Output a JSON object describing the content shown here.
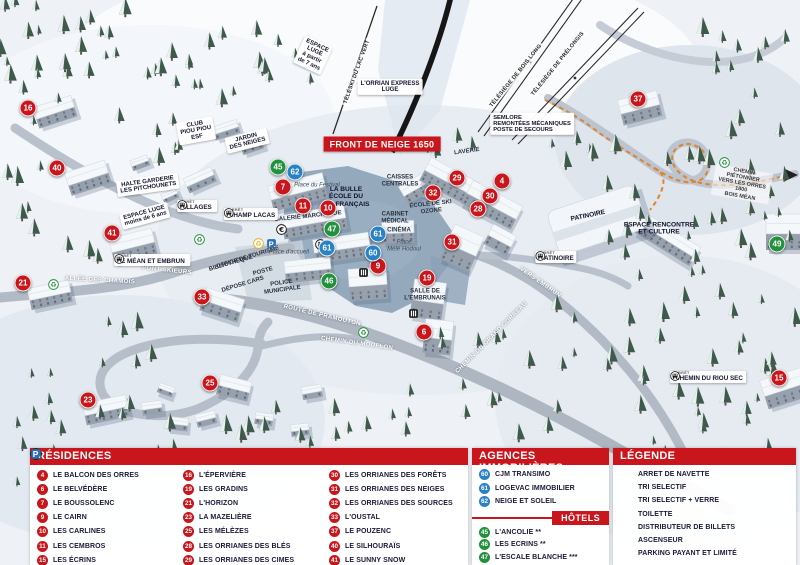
{
  "map": {
    "banner": "FRONT DE NEIGE 1650",
    "stop_prefix": "ARRÊT",
    "labels": [
      {
        "t": "L'ORRIAN EXPRESS\nLUGE",
        "s": "box",
        "x": 390,
        "y": 87,
        "r": 0
      },
      {
        "t": "ESPACE\nLUGE\nà partir\nde 7 ans",
        "s": "box",
        "x": 313,
        "y": 55,
        "r": 25
      },
      {
        "t": "TÉLÉSKI DU LAC VERT",
        "s": "lift",
        "x": 357,
        "y": 72,
        "r": -70
      },
      {
        "t": "TÉLÉSIÈGE DE BOIS LONG",
        "s": "lift",
        "x": 516,
        "y": 76,
        "r": -51
      },
      {
        "t": "TÉLÉSIÈGE DE PRÉLONGIS",
        "s": "lift",
        "x": 558,
        "y": 64,
        "r": -51
      },
      {
        "t": "SEMLORE\nREMONTÉES MÉCANIQUES\nPOSTE DE SECOURS",
        "s": "box-left",
        "x": 532,
        "y": 124,
        "r": 0
      },
      {
        "t": "CLUB\nPIOU PIOU\nESF",
        "s": "box",
        "x": 196,
        "y": 131,
        "r": -10
      },
      {
        "t": "JARDIN\nDES NEIGES",
        "s": "box",
        "x": 247,
        "y": 141,
        "r": -14
      },
      {
        "t": "HALTE GARDERIE\nLES PITCHOUNETS",
        "s": "box",
        "x": 148,
        "y": 185,
        "r": -8
      },
      {
        "t": "ESPACE LUGE\nmoins de 6 ans",
        "s": "box",
        "x": 145,
        "y": 216,
        "r": -15
      },
      {
        "t": "ALLÉE DES CHAMOIS",
        "s": "road",
        "x": 100,
        "y": 281,
        "r": 3
      },
      {
        "t": "PONT SKIEURS",
        "s": "road",
        "x": 167,
        "y": 271,
        "r": 6
      },
      {
        "t": "BIBLIOTHÈQUE",
        "s": "plain",
        "x": 231,
        "y": 264,
        "r": -16
      },
      {
        "t": "OFFICE DE TOURISME",
        "s": "plain",
        "x": 248,
        "y": 258,
        "r": -17
      },
      {
        "t": "POSTE",
        "s": "plain",
        "x": 263,
        "y": 272,
        "r": -15
      },
      {
        "t": "DÉPOSE CARS",
        "s": "plain",
        "x": 243,
        "y": 285,
        "r": -17
      },
      {
        "t": "POLICE\nMUNICIPALE",
        "s": "plain",
        "x": 282,
        "y": 287,
        "r": -8
      },
      {
        "t": "Place d'accueil",
        "s": "italic",
        "x": 289,
        "y": 253,
        "r": 0
      },
      {
        "t": "Place du Festival",
        "s": "italic",
        "x": 317,
        "y": 186,
        "r": 0
      },
      {
        "t": "LA BULLE\nÉCOLE DU\nSKI FRANÇAIS",
        "s": "plain-strong",
        "x": 346,
        "y": 197,
        "r": 0
      },
      {
        "t": "GALERIE MARCHANDE",
        "s": "plain",
        "x": 308,
        "y": 217,
        "r": -6
      },
      {
        "t": "CAISSES\nCENTRALES",
        "s": "plain",
        "x": 400,
        "y": 181,
        "r": 0
      },
      {
        "t": "CABINET\nMÉDICAL",
        "s": "plain",
        "x": 395,
        "y": 218,
        "r": 0
      },
      {
        "t": "CINÉMA",
        "s": "plain",
        "x": 399,
        "y": 231,
        "r": 0
      },
      {
        "t": "Place\nMélé Hodoul",
        "s": "italic",
        "x": 404,
        "y": 246,
        "r": 0
      },
      {
        "t": "ÉCOLE DE SKI\nOZONE",
        "s": "plain",
        "x": 431,
        "y": 208,
        "r": -6
      },
      {
        "t": "LAVERIE",
        "s": "plain",
        "x": 467,
        "y": 152,
        "r": -8
      },
      {
        "t": "SALLE DE\nL'EMBRUNAIS",
        "s": "plain",
        "x": 425,
        "y": 295,
        "r": 0
      },
      {
        "t": "PATINOIRE",
        "s": "plain-strong",
        "x": 588,
        "y": 216,
        "r": -12
      },
      {
        "t": "ESPACE RENCONTRE\nET CULTURE",
        "s": "plain-strong",
        "x": 659,
        "y": 229,
        "r": 0
      },
      {
        "t": "ROUTE DE PRAMOUTON",
        "s": "road",
        "x": 322,
        "y": 316,
        "r": 13
      },
      {
        "t": "CHEMIN DU MOUFLON",
        "s": "road",
        "x": 357,
        "y": 344,
        "r": 8
      },
      {
        "t": "CHEMIN DU GRAND CORREAU",
        "s": "road",
        "x": 492,
        "y": 338,
        "r": -45
      },
      {
        "t": "VERS EMBRUN",
        "s": "road",
        "x": 540,
        "y": 283,
        "r": 35
      },
      {
        "t": "CHEMIN PIÉTONNIER\nVERS LES ORRES 1800\nBOIS MÉAN",
        "s": "path-lbl",
        "x": 742,
        "y": 184,
        "r": 10
      }
    ],
    "stops": [
      {
        "name": "VILLAGES",
        "x": 197,
        "y": 206,
        "side": "right"
      },
      {
        "name": "CHAMP LACAS",
        "x": 251,
        "y": 214,
        "side": "left"
      },
      {
        "name": "LE MÉAN ET EMBRUN",
        "x": 152,
        "y": 260,
        "side": "right"
      },
      {
        "name": "PATINOIRE",
        "x": 556,
        "y": 257,
        "side": "left"
      },
      {
        "name": "CHEMIN DU RIOU SEC",
        "x": 708,
        "y": 377,
        "side": "left"
      }
    ],
    "markers": [
      {
        "n": "16",
        "c": "red",
        "x": 28,
        "y": 108
      },
      {
        "n": "40",
        "c": "red",
        "x": 57,
        "y": 168
      },
      {
        "n": "41",
        "c": "red",
        "x": 112,
        "y": 233
      },
      {
        "n": "21",
        "c": "red",
        "x": 23,
        "y": 283
      },
      {
        "n": "33",
        "c": "red",
        "x": 202,
        "y": 297
      },
      {
        "n": "23",
        "c": "red",
        "x": 88,
        "y": 400
      },
      {
        "n": "25",
        "c": "red",
        "x": 210,
        "y": 383
      },
      {
        "n": "7",
        "c": "red",
        "x": 283,
        "y": 187
      },
      {
        "n": "11",
        "c": "red",
        "x": 303,
        "y": 206
      },
      {
        "n": "10",
        "c": "red",
        "x": 328,
        "y": 208
      },
      {
        "n": "9",
        "c": "red",
        "x": 378,
        "y": 266
      },
      {
        "n": "19",
        "c": "red",
        "x": 427,
        "y": 278
      },
      {
        "n": "6",
        "c": "red",
        "x": 424,
        "y": 332
      },
      {
        "n": "31",
        "c": "red",
        "x": 452,
        "y": 242
      },
      {
        "n": "32",
        "c": "red",
        "x": 433,
        "y": 193
      },
      {
        "n": "29",
        "c": "red",
        "x": 457,
        "y": 178
      },
      {
        "n": "4",
        "c": "red",
        "x": 502,
        "y": 181
      },
      {
        "n": "30",
        "c": "red",
        "x": 490,
        "y": 196
      },
      {
        "n": "28",
        "c": "red",
        "x": 478,
        "y": 209
      },
      {
        "n": "37",
        "c": "red",
        "x": 638,
        "y": 99
      },
      {
        "n": "15",
        "c": "red",
        "x": 779,
        "y": 378
      },
      {
        "n": "45",
        "c": "green",
        "x": 278,
        "y": 167
      },
      {
        "n": "47",
        "c": "green",
        "x": 332,
        "y": 229
      },
      {
        "n": "46",
        "c": "green",
        "x": 329,
        "y": 281
      },
      {
        "n": "49",
        "c": "green",
        "x": 777,
        "y": 244
      },
      {
        "n": "62",
        "c": "blue",
        "x": 295,
        "y": 172
      },
      {
        "n": "61",
        "c": "blue",
        "x": 378,
        "y": 234
      },
      {
        "n": "61",
        "c": "blue",
        "x": 327,
        "y": 248
      },
      {
        "n": "60",
        "c": "blue",
        "x": 373,
        "y": 253
      }
    ],
    "icons": [
      {
        "icon": "recycle-green",
        "x": 48,
        "y": 279
      },
      {
        "icon": "recycle-green",
        "x": 194,
        "y": 234
      },
      {
        "icon": "recycle-green",
        "x": 358,
        "y": 327
      },
      {
        "icon": "recycle-green",
        "x": 719,
        "y": 157
      },
      {
        "icon": "recycle-yellow",
        "x": 253,
        "y": 238
      },
      {
        "icon": "parking",
        "x": 266,
        "y": 238
      },
      {
        "icon": "euro",
        "x": 276,
        "y": 224
      },
      {
        "icon": "wc",
        "x": 315,
        "y": 239
      },
      {
        "icon": "elevator",
        "x": 358,
        "y": 267
      },
      {
        "icon": "elevator",
        "x": 408,
        "y": 308
      }
    ]
  },
  "legend": {
    "residences": {
      "title": "RÉSIDENCES",
      "columns": [
        [
          {
            "n": "4",
            "label": "LE BALCON DES ORRES"
          },
          {
            "n": "6",
            "label": "LE BELVÉDÈRE"
          },
          {
            "n": "7",
            "label": "LE BOUSSOLENC"
          },
          {
            "n": "9",
            "label": "LE CAIRN"
          },
          {
            "n": "10",
            "label": "LES CARLINES"
          },
          {
            "n": "11",
            "label": "LES CEMBROS"
          },
          {
            "n": "15",
            "label": "LES ÉCRINS"
          }
        ],
        [
          {
            "n": "16",
            "label": "L'ÉPERVIÈRE"
          },
          {
            "n": "19",
            "label": "LES GRADINS"
          },
          {
            "n": "21",
            "label": "L'HORIZON"
          },
          {
            "n": "23",
            "label": "LA MAZELIÈRE"
          },
          {
            "n": "25",
            "label": "LES MÉLÈZES"
          },
          {
            "n": "28",
            "label": "LES ORRIANES DES BLÉS"
          },
          {
            "n": "29",
            "label": "LES ORRIANES DES CIMES"
          }
        ],
        [
          {
            "n": "30",
            "label": "LES ORRIANES DES FORÊTS"
          },
          {
            "n": "31",
            "label": "LES ORRIANES DES NEIGES"
          },
          {
            "n": "32",
            "label": "LES ORRIANES DES SOURCES"
          },
          {
            "n": "33",
            "label": "L'OUSTAL"
          },
          {
            "n": "37",
            "label": "LE POUZENC"
          },
          {
            "n": "40",
            "label": "LE SILHOURAÏS"
          },
          {
            "n": "41",
            "label": "LE SUNNY SNOW"
          }
        ]
      ]
    },
    "agences": {
      "title": "AGENCES IMMOBILIÈRES",
      "items": [
        {
          "n": "60",
          "label": "CJM TRANSIMO"
        },
        {
          "n": "61",
          "label": "LOGEVAC IMMOBILIER"
        },
        {
          "n": "62",
          "label": "NEIGE ET SOLEIL"
        }
      ]
    },
    "hotels": {
      "title": "HÔTELS",
      "items": [
        {
          "n": "45",
          "label": "L'ANCOLIE **"
        },
        {
          "n": "46",
          "label": "LES ECRINS **"
        },
        {
          "n": "47",
          "label": "L'ESCALE BLANCHE ***"
        },
        {
          "n": "49",
          "label": "LES TRAPPEURS **"
        }
      ]
    },
    "legende": {
      "title": "LÉGENDE",
      "items": [
        {
          "icon": "bus",
          "label": "ARRET DE NAVETTE"
        },
        {
          "icon": "recycle-green",
          "label": "TRI SELECTIF"
        },
        {
          "icon": "recycle-yellow",
          "label": "TRI SELECTIF + VERRE"
        },
        {
          "icon": "wc",
          "label": "TOILETTE"
        },
        {
          "icon": "euro",
          "label": "DISTRIBUTEUR DE BILLETS"
        },
        {
          "icon": "elevator",
          "label": "ASCENSEUR"
        },
        {
          "icon": "parking",
          "label": "PARKING PAYANT ET LIMITÉ"
        }
      ]
    }
  },
  "colors": {
    "red": "#c9161d",
    "green": "#22913c",
    "blue": "#2a82c6",
    "orange": "#e1842a"
  }
}
